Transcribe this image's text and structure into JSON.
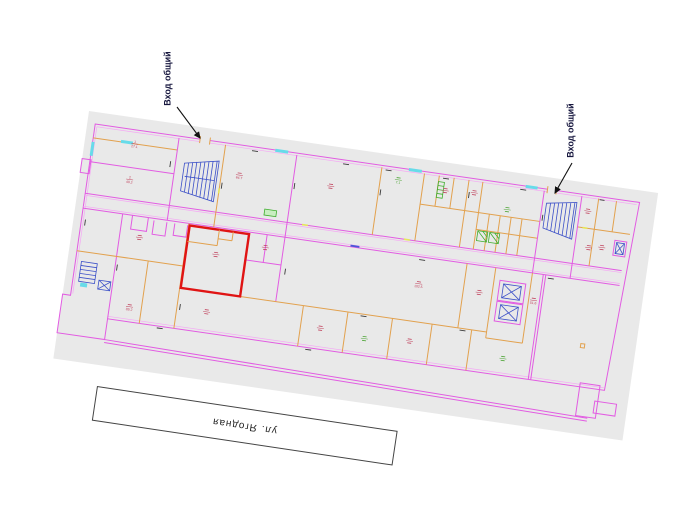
{
  "annotations": {
    "entrance_label_1": "Вход общий",
    "entrance_label_2": "Вход общий",
    "street_label": "ул. Ягодная"
  },
  "plan": {
    "sheet_color": "#e9e9e9",
    "colors": {
      "outer_wall": "#e25ce2",
      "partition": "#e2a14e",
      "highlight_room": "#e01414",
      "stairs": "#3c50c8",
      "window": "#67dbe9",
      "fixture_green": "#3fae2e",
      "label_red": "#c0415c",
      "label_green": "#4aa332",
      "annotation_text": "#16163e"
    },
    "room_labels": [
      {
        "x": 50,
        "y": 26,
        "c": "#c0415c",
        "n": "1",
        "a": "27.1"
      },
      {
        "x": 50,
        "y": 62,
        "c": "#c0415c",
        "n": "2",
        "a": "40.2"
      },
      {
        "x": 158,
        "y": 42,
        "c": "#c0415c",
        "n": "",
        "a": "64.7"
      },
      {
        "x": 250,
        "y": 40,
        "c": "#c0415c",
        "n": "",
        "a": ""
      },
      {
        "x": 316,
        "y": 24,
        "c": "#4aa332",
        "n": "",
        "a": "7.1"
      },
      {
        "x": 364,
        "y": 28,
        "c": "#c0415c",
        "n": "",
        "a": ""
      },
      {
        "x": 393,
        "y": 26,
        "c": "#c0415c",
        "n": "",
        "a": ""
      },
      {
        "x": 428,
        "y": 38,
        "c": "#4aa332",
        "n": "",
        "a": ""
      },
      {
        "x": 508,
        "y": 28,
        "c": "#c0415c",
        "n": "",
        "a": ""
      },
      {
        "x": 527,
        "y": 62,
        "c": "#c0415c",
        "n": "",
        "a": ""
      },
      {
        "x": 146,
        "y": 124,
        "c": "#c0415c",
        "n": "",
        "a": ""
      },
      {
        "x": 194,
        "y": 110,
        "c": "#c0415c",
        "n": "",
        "a": ""
      },
      {
        "x": 351,
        "y": 124,
        "c": "#c0415c",
        "n": "",
        "a": "102.5"
      },
      {
        "x": 68,
        "y": 118,
        "c": "#c0415c",
        "n": "",
        "a": ""
      },
      {
        "x": 68,
        "y": 188,
        "c": "#c0415c",
        "n": "",
        "a": "89.2"
      },
      {
        "x": 145,
        "y": 182,
        "c": "#c0415c",
        "n": "",
        "a": ""
      },
      {
        "x": 260,
        "y": 182,
        "c": "#c0415c",
        "n": "",
        "a": ""
      },
      {
        "x": 305,
        "y": 186,
        "c": "#4aa332",
        "n": "",
        "a": ""
      },
      {
        "x": 350,
        "y": 182,
        "c": "#c0415c",
        "n": "",
        "a": ""
      },
      {
        "x": 467,
        "y": 124,
        "c": "#c0415c",
        "n": "",
        "a": "51.6"
      },
      {
        "x": 445,
        "y": 186,
        "c": "#4aa332",
        "n": "",
        "a": ""
      },
      {
        "x": 514,
        "y": 64,
        "c": "#c0415c",
        "n": "",
        "a": ""
      },
      {
        "x": 412,
        "y": 124,
        "c": "#c0415c",
        "n": "",
        "a": ""
      }
    ]
  }
}
